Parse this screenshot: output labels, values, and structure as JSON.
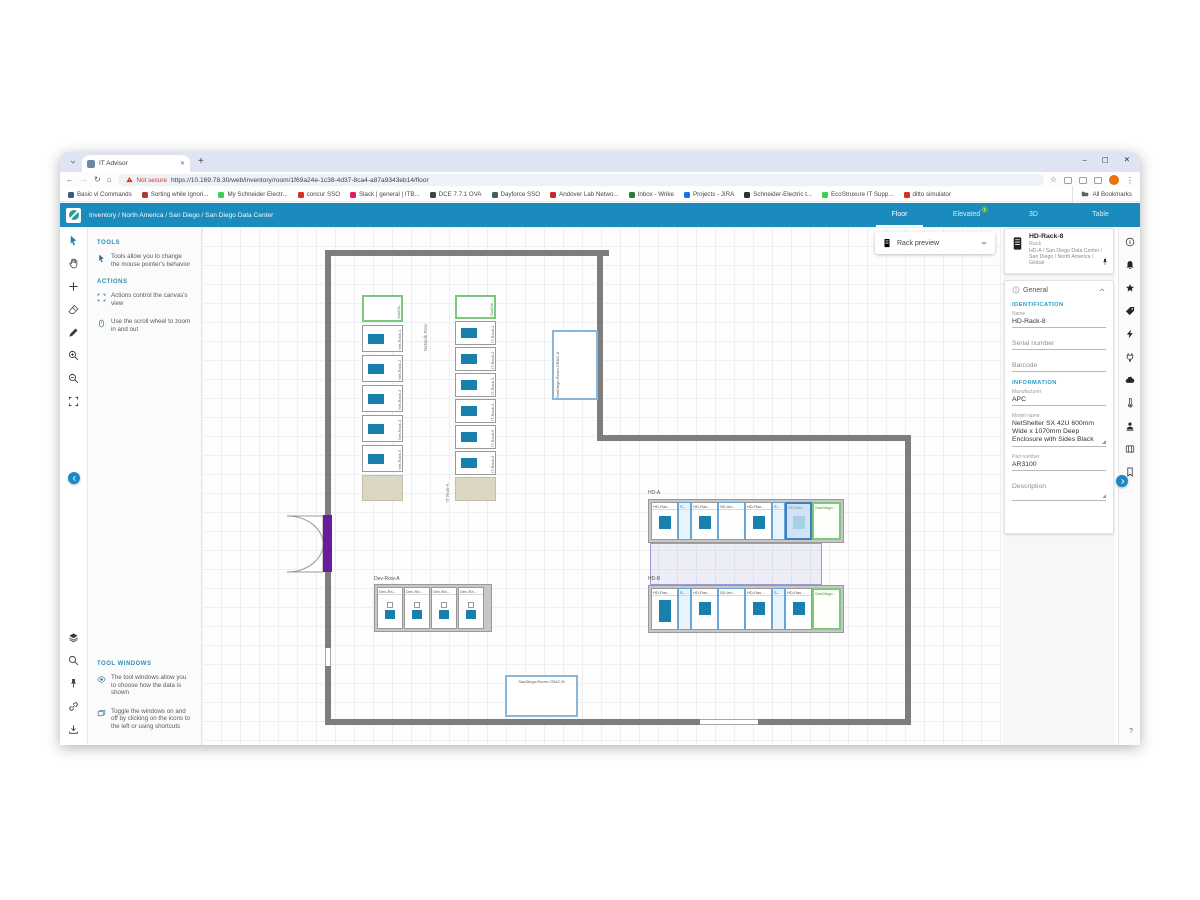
{
  "browser": {
    "tab": {
      "title": "IT Advisor"
    },
    "window_controls": {
      "minimize": "–",
      "maximize": "▢",
      "close": "✕"
    },
    "address": {
      "security_label": "Not secure",
      "url": "https://10.169.78.30/web/inventory/room/1f69a24e-1c38-4d37-8ca4-a87a9343eb14/floor"
    },
    "bookmarks": [
      {
        "label": "Basic vi Commands",
        "color": "#3b5b7a"
      },
      {
        "label": "Sorting while Ignori...",
        "color": "#b03a2e"
      },
      {
        "label": "My Schneider Electr...",
        "color": "#3dcd58"
      },
      {
        "label": "concur SSO",
        "color": "#d93025"
      },
      {
        "label": "Slack | general | ITB...",
        "color": "#e01e5a"
      },
      {
        "label": "DCE 7.7.1 OVA",
        "color": "#37474f"
      },
      {
        "label": "Dayforce SSO",
        "color": "#455a64"
      },
      {
        "label": "Andover Lab Netwo...",
        "color": "#c62828"
      },
      {
        "label": "Inbox - Wrike",
        "color": "#2e7d32"
      },
      {
        "label": "Projects - JIRA",
        "color": "#1a73e8"
      },
      {
        "label": "Schneider-Electric t...",
        "color": "#263238"
      },
      {
        "label": "EcoStruxure IT Supp...",
        "color": "#3dcd58"
      },
      {
        "label": "ditto simulator",
        "color": "#d93025"
      }
    ],
    "all_bookmarks_label": "All Bookmarks"
  },
  "app_header": {
    "breadcrumb": "Inventory / North America / San Diego / San Diego Data Center",
    "tabs": [
      {
        "label": "Floor",
        "active": true
      },
      {
        "label": "Elevated",
        "badge": "1"
      },
      {
        "label": "3D"
      },
      {
        "label": "Table"
      }
    ]
  },
  "tool_panel": {
    "top_tools": [
      "cursor",
      "hand",
      "plus",
      "eraser",
      "pencil",
      "zoom-in",
      "zoom-out",
      "fit"
    ],
    "bottom_tools": [
      "layers",
      "search",
      "pin",
      "link",
      "download"
    ],
    "sections": [
      {
        "title": "TOOLS",
        "items": [
          {
            "icon": "cursor",
            "text": "Tools allow you to change the mouse pointer's behavior"
          }
        ]
      },
      {
        "title": "ACTIONS",
        "items": [
          {
            "icon": "fit",
            "text": "Actions control the canvas's view"
          },
          {
            "icon": "mouse",
            "text": "Use the scroll wheel to zoom in and out"
          }
        ]
      },
      {
        "title": "TOOL WINDOWS",
        "items": [
          {
            "icon": "eye",
            "text": "The tool windows allow you to choose how the data is shown"
          },
          {
            "icon": "windows",
            "text": "Toggle the windows on and off by clicking on the icons to the left or using shortcuts"
          }
        ]
      }
    ]
  },
  "canvas": {
    "rack_preview_label": "Rack preview",
    "floorplan": {
      "network_row": {
        "label": "Network Row",
        "top_rack": "SanDie...",
        "racks": [
          "Net-Rack-1",
          "Net-Rack-2",
          "Net-Rack-3",
          "Net-Rack-4",
          "Net-Rack-5"
        ]
      },
      "it_row_a": {
        "label": "IT Row-A",
        "top_rack": "SanDie...",
        "racks": [
          "IT-Rack-1",
          "IT-Rack-2",
          "IT-Rack-3",
          "IT-Rack-4",
          "IT-Rack-5",
          "IT-Rack-6"
        ]
      },
      "hd_a": {
        "label": "HD-A",
        "racks": [
          {
            "label": "HD-Rac...",
            "kind": "rack"
          },
          {
            "label": "S...",
            "kind": "narrow"
          },
          {
            "label": "HD-Rac...",
            "kind": "rack"
          },
          {
            "label": "SD-Inv...",
            "kind": "outline"
          },
          {
            "label": "HD-Rac...",
            "kind": "rack"
          },
          {
            "label": "S...",
            "kind": "narrow"
          },
          {
            "label": "HD-Rac...",
            "kind": "selected"
          },
          {
            "label": "SanDiego...",
            "kind": "green"
          }
        ]
      },
      "hd_b": {
        "label": "HD-B",
        "racks": [
          {
            "label": "HD-Rac...",
            "kind": "rack-tall"
          },
          {
            "label": "S...",
            "kind": "narrow"
          },
          {
            "label": "HD-Rac...",
            "kind": "rack"
          },
          {
            "label": "SD-Inv...",
            "kind": "outline"
          },
          {
            "label": "HD-Rac...",
            "kind": "rack"
          },
          {
            "label": "S...",
            "kind": "narrow"
          },
          {
            "label": "HD-Rac...",
            "kind": "rack"
          },
          {
            "label": "SanDiego...",
            "kind": "green"
          }
        ]
      },
      "dev_row": {
        "label": "Dev-Row-A",
        "racks": [
          "Dev-Ra...",
          "Dev-Ra...",
          "Dev-Ra...",
          "Dev-Ra..."
        ]
      },
      "crac_a": "SanDiego-Room-CRAC-A",
      "crac_b": "SanDiego-Room-CRAC-B"
    }
  },
  "right_panel": {
    "header": {
      "name": "HD-Rack-8",
      "type": "Rack",
      "location": "HD-A / San Diego Data Center / San Diego / North America / Global"
    },
    "general": {
      "title": "General",
      "sections": [
        {
          "title": "IDENTIFICATION",
          "fields": [
            {
              "label": "Name",
              "value": "HD-Rack-8"
            },
            {
              "label": "Serial number",
              "value": ""
            },
            {
              "label": "Barcode",
              "value": ""
            }
          ]
        },
        {
          "title": "INFORMATION",
          "fields": [
            {
              "label": "Manufacturer",
              "value": "APC"
            },
            {
              "label": "Model name",
              "value": "NetShelter SX 42U 600mm Wide x 1070mm Deep Enclosure with Sides Black",
              "multiline": true
            },
            {
              "label": "Part number",
              "value": "AR3100"
            },
            {
              "label": "Description",
              "value": "",
              "multiline": true
            }
          ]
        }
      ]
    },
    "side_icons": [
      "info",
      "bell",
      "star",
      "tag",
      "bolt",
      "plug",
      "cloud",
      "thermo",
      "person",
      "card",
      "bookmark"
    ],
    "help_label": "?"
  },
  "colors": {
    "app_accent": "#1b8bbd",
    "selection_blue": "#3f7fc1",
    "rack_fill_blue": "#1980ad",
    "green_rack_border": "#7ec87e",
    "badge_green": "#4caf50",
    "not_secure_red": "#d93025",
    "door_purple": "#6a1b9a"
  }
}
